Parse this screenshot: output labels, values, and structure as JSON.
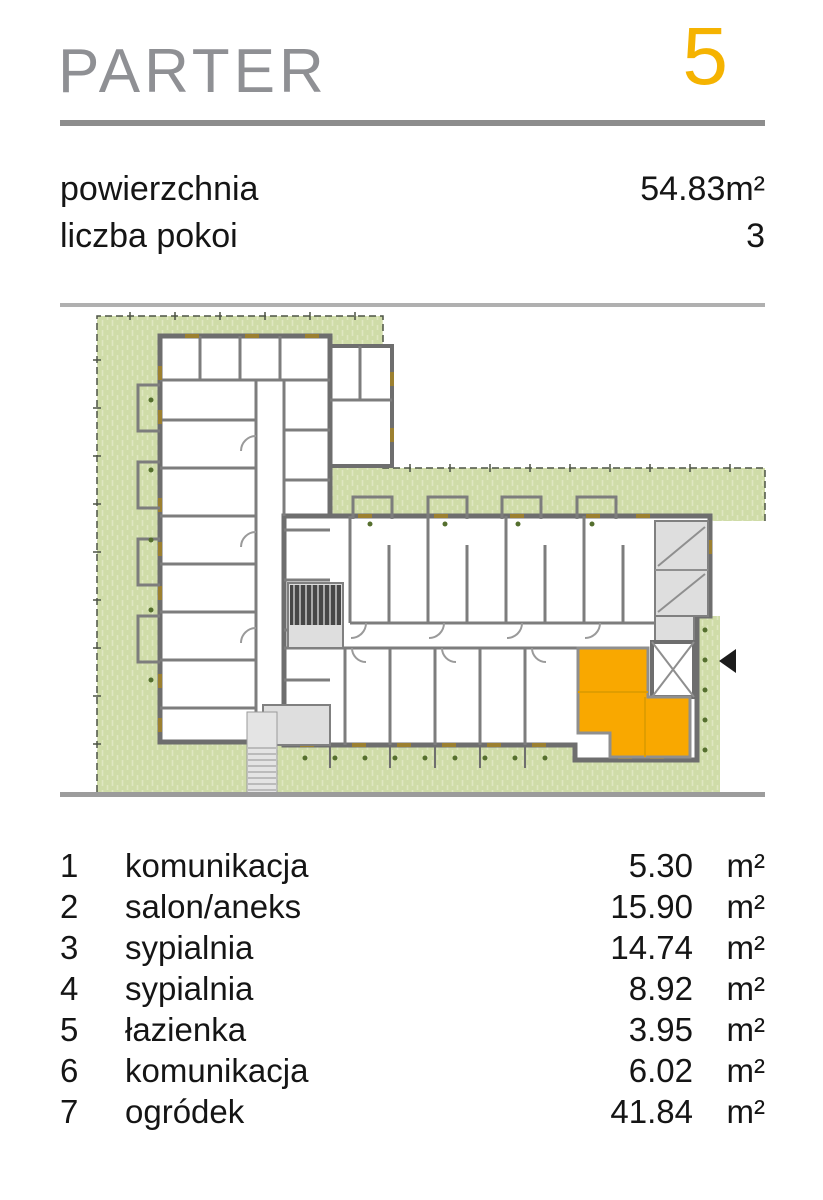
{
  "header": {
    "title": "PARTER",
    "unit_number": "5"
  },
  "theme": {
    "accent": "#F5B301",
    "unit-fill": "#F9A800",
    "title-gray": "#8F9094",
    "text": "#151515",
    "rule-a": "#8D8D8D",
    "rule-b": "#B0B0B0",
    "rule-c": "#9C9C9C",
    "green": "#CFDCA8",
    "green-hatch": "#DFE7C1",
    "wall": "#6E6E6E",
    "window-tan": "#9C8030",
    "plant": "#556F2E"
  },
  "summary": {
    "rows": [
      {
        "label": "powierzchnia",
        "value": "54.83m²"
      },
      {
        "label": "liczba pokoi",
        "value": "3"
      }
    ]
  },
  "plan": {
    "type": "floor-plan",
    "highlighted_unit": "5",
    "highlight_color": "#F9A800",
    "icons": [
      "elevator-x-icon",
      "entrance-arrow-icon",
      "staircase-icon"
    ]
  },
  "rooms": {
    "unit": "m²",
    "items": [
      {
        "no": "1",
        "name": "komunikacja",
        "area": "5.30"
      },
      {
        "no": "2",
        "name": "salon/aneks",
        "area": "15.90"
      },
      {
        "no": "3",
        "name": "sypialnia",
        "area": "14.74"
      },
      {
        "no": "4",
        "name": "sypialnia",
        "area": "8.92"
      },
      {
        "no": "5",
        "name": "łazienka",
        "area": "3.95"
      },
      {
        "no": "6",
        "name": "komunikacja",
        "area": "6.02"
      },
      {
        "no": "7",
        "name": "ogródek",
        "area": "41.84"
      }
    ]
  }
}
